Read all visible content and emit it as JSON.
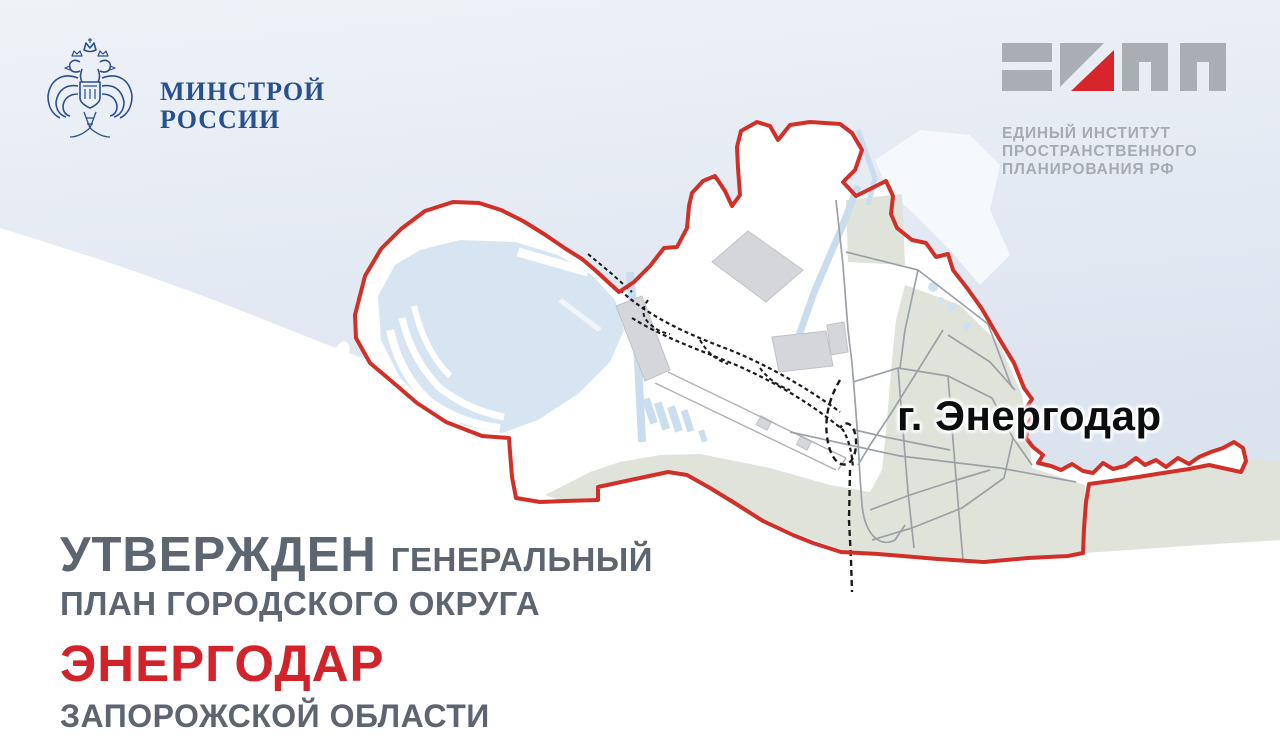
{
  "minstroy_logo": {
    "emblem_icon": "double-headed-eagle-emblem",
    "line1": "МИНСТРОЙ",
    "line2": "РОССИИ",
    "text_color": "#27508f"
  },
  "eipp_logo": {
    "logomark_icon": "eipp-glyphs-ЕИПП",
    "line1": "ЕДИНЫЙ ИНСТИТУТ",
    "line2": "ПРОСТРАНСТВЕННОГО",
    "line3": "ПЛАНИРОВАНИЯ РФ",
    "gray_color": "#a6abb2",
    "accent_red": "#d8242b"
  },
  "map": {
    "city_label": "г. Энергодар",
    "boundary_color": "#d13028",
    "water_color": "#e6ebf4",
    "land_color": "#ffffff",
    "green_color": "#dfe3da",
    "reservoir_color": "#d7e5f3",
    "building_color": "#d4d6da",
    "road_color": "#9ca1a8",
    "railway_color": "#1b1b1b"
  },
  "title": {
    "approved": "УТВЕРЖДЕН",
    "general": "ГЕНЕРАЛЬНЫЙ",
    "line2": "ПЛАН ГОРОДСКОГО ОКРУГА",
    "city": "ЭНЕРГОДАР",
    "region": "ЗАПОРОЖСКОЙ ОБЛАСТИ",
    "gray_color": "#5c6570",
    "red_color": "#d2232a"
  }
}
